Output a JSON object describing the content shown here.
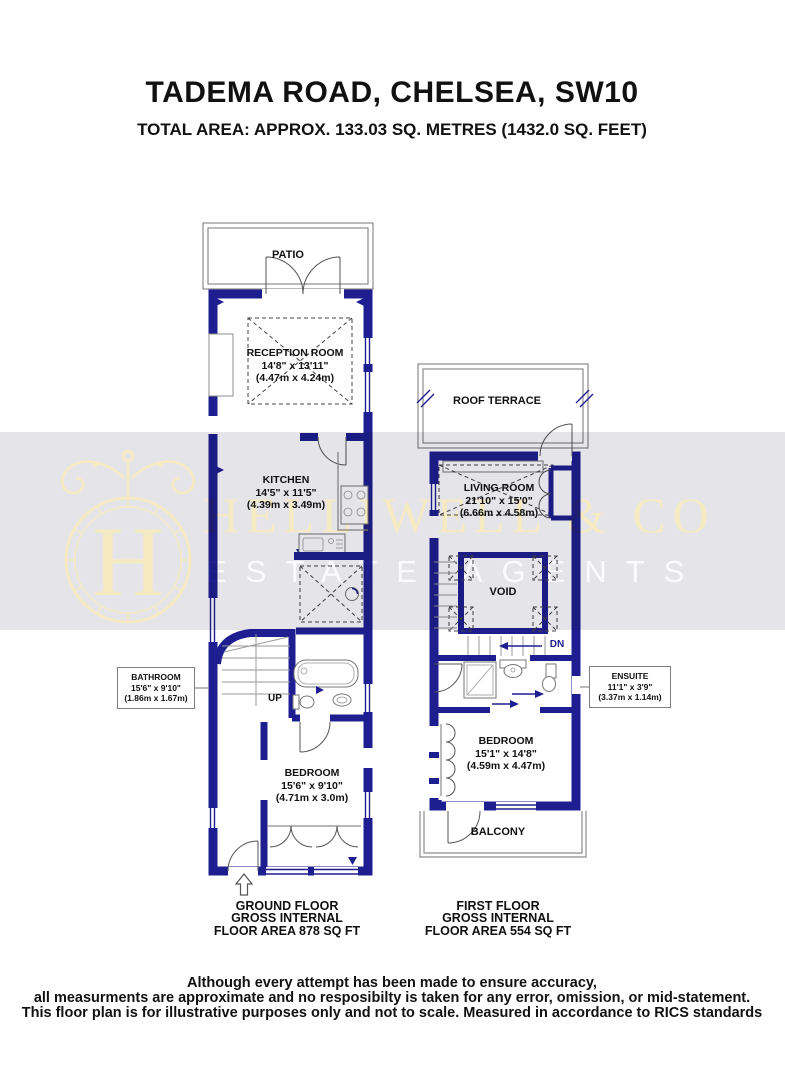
{
  "header": {
    "title": "TADEMA ROAD, CHELSEA, SW10",
    "subtitle": "TOTAL AREA: APPROX. 133.03 SQ. METRES (1432.0 SQ. FEET)"
  },
  "watermark": {
    "brand": "HELLIWELL & CO",
    "tagline": "ESTATE AGENTS",
    "monogram": "H",
    "band_color": "#e4e4e9",
    "brand_color": "#f5eac2"
  },
  "colors": {
    "wall": "#1e1e90",
    "outline": "#8c8c8c",
    "text": "#111111"
  },
  "ground_floor": {
    "patio_label": "PATIO",
    "stairs_label": "UP",
    "rooms": {
      "reception": {
        "name": "RECEPTION ROOM",
        "imperial": "14'8\" x 13'11\"",
        "metric": "(4.47m x 4.24m)"
      },
      "kitchen": {
        "name": "KITCHEN",
        "imperial": "14'5\" x 11'5\"",
        "metric": "(4.39m x 3.49m)"
      },
      "bedroom": {
        "name": "BEDROOM",
        "imperial": "15'6\" x 9'10\"",
        "metric": "(4.71m x 3.0m)"
      }
    },
    "callout": {
      "name": "BATHROOM",
      "imperial": "15'6\" x 9'10\"",
      "metric": "(1.86m x 1.67m)"
    },
    "caption": [
      "GROUND FLOOR",
      "GROSS INTERNAL",
      "FLOOR AREA 878 SQ FT"
    ]
  },
  "first_floor": {
    "terrace_label": "ROOF TERRACE",
    "balcony_label": "BALCONY",
    "stairs_label": "DN",
    "rooms": {
      "living": {
        "name": "LIVING ROOM",
        "imperial": "21'10\" x 15'0\"",
        "metric": "(6.66m x 4.58m)"
      },
      "void": {
        "name": "VOID"
      },
      "bedroom": {
        "name": "BEDROOM",
        "imperial": "15'1\" x 14'8\"",
        "metric": "(4.59m x 4.47m)"
      }
    },
    "callout": {
      "name": "ENSUITE",
      "imperial": "11'1\" x 3'9\"",
      "metric": "(3.37m x 1.14m)"
    },
    "caption": [
      "FIRST FLOOR",
      "GROSS INTERNAL",
      "FLOOR AREA 554 SQ FT"
    ]
  },
  "footer": {
    "lines": [
      "Although every attempt has been made to ensure accuracy,",
      "all measurments are approximate and no resposibilty is taken for any error, omission, or mid-statement.",
      "This floor plan is for illustrative purposes only and not to scale. Measured in accordance to RICS standards"
    ]
  }
}
